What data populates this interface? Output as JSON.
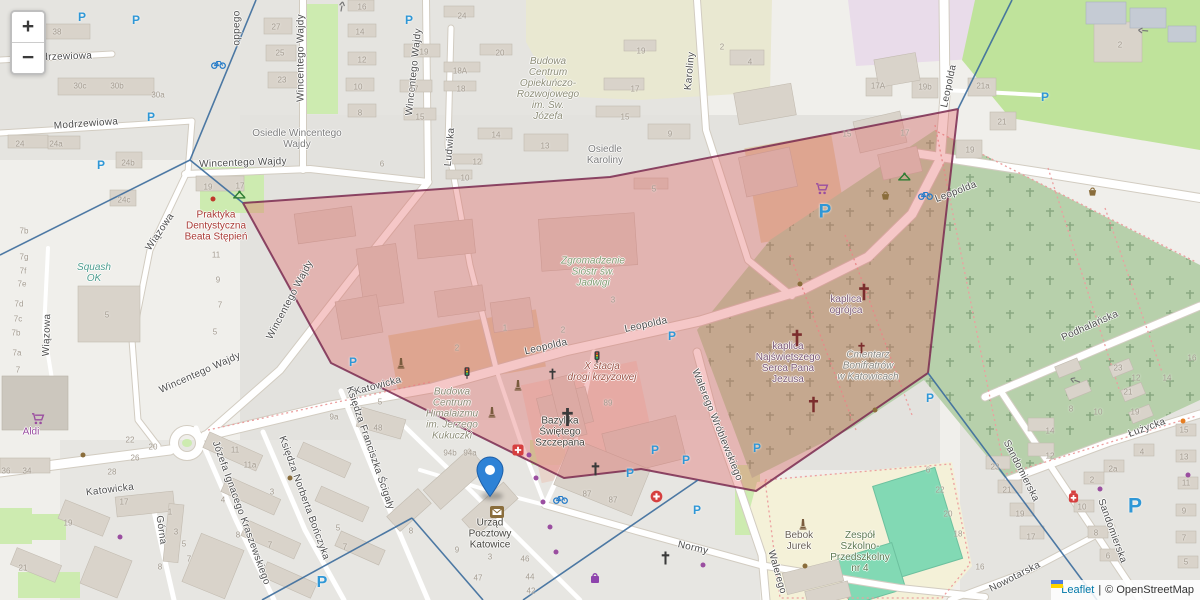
{
  "controls": {
    "zoom_in": "+",
    "zoom_out": "−"
  },
  "attribution": {
    "leaflet": "Leaflet",
    "separator": "|",
    "osm": "© OpenStreetMap"
  },
  "marker": {
    "title": "Urząd Pocztowy Katowice"
  },
  "colors": {
    "highlight_fill": "#e25b5b",
    "highlight_stroke": "#7a2a50",
    "boundary_line": "#3b6c9c",
    "marker_blue": "#2e82d6",
    "parking_blue": "#2f97d6",
    "link_blue": "#0078a8"
  },
  "overlay": {
    "highlight_polygon": [
      [
        243,
        203
      ],
      [
        610,
        177
      ],
      [
        958,
        109
      ],
      [
        928,
        373
      ],
      [
        756,
        491
      ],
      [
        641,
        469
      ],
      [
        564,
        478
      ],
      [
        331,
        363
      ]
    ],
    "boundary_lines": [
      [
        [
          256,
          0
        ],
        [
          190,
          160
        ]
      ],
      [
        [
          190,
          160
        ],
        [
          0,
          255
        ]
      ],
      [
        [
          190,
          160
        ],
        [
          243,
          203
        ]
      ],
      [
        [
          1012,
          0
        ],
        [
          958,
          109
        ]
      ],
      [
        [
          928,
          373
        ],
        [
          1097,
          600
        ]
      ],
      [
        [
          698,
          480
        ],
        [
          523,
          600
        ]
      ],
      [
        [
          412,
          518
        ],
        [
          483,
          600
        ]
      ],
      [
        [
          412,
          518
        ],
        [
          262,
          600
        ]
      ]
    ]
  },
  "street_labels": [
    {
      "t": "Modrzewiowa",
      "x": 60,
      "y": 57,
      "r": -2
    },
    {
      "t": "Modrzewiowa",
      "x": 86,
      "y": 124,
      "r": -4
    },
    {
      "t": "oppego",
      "x": 237,
      "y": 28,
      "r": -90
    },
    {
      "t": "Wincentego Wajdy",
      "x": 301,
      "y": 58,
      "r": -90
    },
    {
      "t": "Wincentego Wajdy",
      "x": 414,
      "y": 72,
      "r": -84
    },
    {
      "t": "Wincentego Wajdy",
      "x": 243,
      "y": 163,
      "r": -2
    },
    {
      "t": "Wincentego Wajdy",
      "x": 200,
      "y": 373,
      "r": -24
    },
    {
      "t": "Wincentego Wajdy",
      "x": 290,
      "y": 300,
      "r": -62
    },
    {
      "t": "Wiązowa",
      "x": 160,
      "y": 232,
      "r": -56
    },
    {
      "t": "Wiązowa",
      "x": 47,
      "y": 335,
      "r": -88
    },
    {
      "t": "Ludwika",
      "x": 450,
      "y": 147,
      "r": -85
    },
    {
      "t": "Karoliny",
      "x": 690,
      "y": 71,
      "r": -85
    },
    {
      "t": "Katowicka",
      "x": 378,
      "y": 386,
      "r": -15
    },
    {
      "t": "Katowicka",
      "x": 110,
      "y": 490,
      "r": -7
    },
    {
      "t": "Leopolda",
      "x": 546,
      "y": 347,
      "r": -13
    },
    {
      "t": "Leopolda",
      "x": 646,
      "y": 325,
      "r": -12
    },
    {
      "t": "Leopolda",
      "x": 956,
      "y": 192,
      "r": -21
    },
    {
      "t": "Leopolda",
      "x": 949,
      "y": 86,
      "r": -78
    },
    {
      "t": "Walerego Wróblewskiego",
      "x": 717,
      "y": 425,
      "r": 68
    },
    {
      "t": "Walerego",
      "x": 777,
      "y": 572,
      "r": 74
    },
    {
      "t": "Normy",
      "x": 693,
      "y": 548,
      "r": 13
    },
    {
      "t": "Nowotarska",
      "x": 1015,
      "y": 577,
      "r": -27
    },
    {
      "t": "Sandomierska",
      "x": 1021,
      "y": 471,
      "r": 63
    },
    {
      "t": "Sandomierska",
      "x": 1112,
      "y": 531,
      "r": 70
    },
    {
      "t": "Łużycka",
      "x": 1147,
      "y": 428,
      "r": -20
    },
    {
      "t": "Podhalańska",
      "x": 1090,
      "y": 326,
      "r": -24
    },
    {
      "t": "Górna",
      "x": 161,
      "y": 530,
      "r": 82
    },
    {
      "t": "Józefa Ignacego Kraszewskiego",
      "x": 241,
      "y": 513,
      "r": 70
    },
    {
      "t": "Księdza Norberta Bończyka",
      "x": 304,
      "y": 498,
      "r": 70
    },
    {
      "t": "Księdza Franciszka Ścigały",
      "x": 370,
      "y": 448,
      "r": 71
    }
  ],
  "place_labels": [
    {
      "lines": [
        "Osiedle Wincentego",
        "Wajdy"
      ],
      "x": 297,
      "y": 139,
      "c": "gray"
    },
    {
      "lines": [
        "Osiedle",
        "Karoliny"
      ],
      "x": 605,
      "y": 155,
      "c": "gray"
    },
    {
      "lines": [
        "Budowa",
        "Centrum",
        "Opiekuńczo-",
        "Rozwojowego",
        "im. Św.",
        "Józefa"
      ],
      "x": 548,
      "y": 89,
      "c": "constr"
    },
    {
      "lines": [
        "Budowa",
        "Centrum",
        "Himalaizmu",
        "im. Jerzego",
        "Kukuczki"
      ],
      "x": 452,
      "y": 414,
      "c": "constr"
    },
    {
      "lines": [
        "Praktyka",
        "Dentystyczna",
        "Beata Stępień"
      ],
      "x": 216,
      "y": 226,
      "c": "red"
    },
    {
      "lines": [
        "Squash",
        "OK"
      ],
      "x": 94,
      "y": 273,
      "c": "teal"
    },
    {
      "lines": [
        "Zgromadzenie",
        "Sióstr św.",
        "Jadwigi"
      ],
      "x": 593,
      "y": 272,
      "c": "green"
    },
    {
      "lines": [
        "X stacja",
        "drogi krzyżowej"
      ],
      "x": 602,
      "y": 372,
      "c": "hist"
    },
    {
      "lines": [
        "Bazylika",
        "Świętego",
        "Szczepana"
      ],
      "x": 560,
      "y": 432,
      "c": "dark"
    },
    {
      "lines": [
        "kaplica",
        "ogrójca"
      ],
      "x": 846,
      "y": 305,
      "c": "relig"
    },
    {
      "lines": [
        "kaplica",
        "Najświętszego",
        "Serca Pana",
        "Jezusa"
      ],
      "x": 788,
      "y": 363,
      "c": "relig"
    },
    {
      "lines": [
        "Cmentarz",
        "Bonifratrów",
        "w Katowicach"
      ],
      "x": 868,
      "y": 366,
      "c": "cem"
    },
    {
      "lines": [
        "Zespół",
        "Szkolno-",
        "Przedszkolny",
        "nr 4"
      ],
      "x": 860,
      "y": 552,
      "c": "school"
    },
    {
      "lines": [
        "Bebok",
        "Jurek"
      ],
      "x": 799,
      "y": 541,
      "c": "poi"
    },
    {
      "lines": [
        "Urząd",
        "Pocztowy",
        "Katowice"
      ],
      "x": 490,
      "y": 534,
      "c": "dark"
    },
    {
      "lines": [
        "Aldi"
      ],
      "x": 31,
      "y": 432,
      "c": "shop"
    }
  ],
  "house_numbers": [
    [
      "38",
      57,
      32
    ],
    [
      "30c",
      80,
      86
    ],
    [
      "30b",
      117,
      86
    ],
    [
      "30a",
      158,
      95
    ],
    [
      "24",
      20,
      144
    ],
    [
      "24a",
      56,
      144
    ],
    [
      "24b",
      128,
      163
    ],
    [
      "24c",
      124,
      200
    ],
    [
      "27",
      276,
      27
    ],
    [
      "25",
      280,
      53
    ],
    [
      "23",
      282,
      80
    ],
    [
      "16",
      362,
      7
    ],
    [
      "14",
      360,
      32
    ],
    [
      "12",
      362,
      60
    ],
    [
      "10",
      358,
      87
    ],
    [
      "8",
      360,
      113
    ],
    [
      "19",
      424,
      52
    ],
    [
      "17",
      414,
      89
    ],
    [
      "15",
      420,
      117
    ],
    [
      "6",
      382,
      164
    ],
    [
      "24",
      462,
      16
    ],
    [
      "20",
      500,
      53
    ],
    [
      "18A",
      460,
      71
    ],
    [
      "18",
      461,
      89
    ],
    [
      "14",
      496,
      135
    ],
    [
      "13",
      545,
      146
    ],
    [
      "12",
      477,
      162
    ],
    [
      "10",
      465,
      178
    ],
    [
      "19",
      641,
      51
    ],
    [
      "17",
      635,
      89
    ],
    [
      "15",
      625,
      117
    ],
    [
      "9",
      670,
      134
    ],
    [
      "5",
      654,
      189
    ],
    [
      "2",
      722,
      47
    ],
    [
      "4",
      750,
      62
    ],
    [
      "2",
      1120,
      45
    ],
    [
      "17A",
      878,
      86
    ],
    [
      "19b",
      925,
      87
    ],
    [
      "21a",
      983,
      86
    ],
    [
      "21",
      1002,
      122
    ],
    [
      "19",
      970,
      150
    ],
    [
      "17",
      905,
      133
    ],
    [
      "15",
      847,
      134
    ],
    [
      "1",
      505,
      328
    ],
    [
      "2",
      563,
      330
    ],
    [
      "3",
      613,
      300
    ],
    [
      "2",
      457,
      348
    ],
    [
      "5",
      380,
      402
    ],
    [
      "48",
      378,
      428
    ],
    [
      "9a",
      334,
      417
    ],
    [
      "89",
      608,
      403
    ],
    [
      "94b",
      450,
      453
    ],
    [
      "94a",
      470,
      453
    ],
    [
      "87",
      587,
      494
    ],
    [
      "87",
      613,
      500
    ],
    [
      "8",
      411,
      531
    ],
    [
      "9",
      457,
      550
    ],
    [
      "3",
      490,
      557
    ],
    [
      "46",
      525,
      559
    ],
    [
      "44",
      530,
      577
    ],
    [
      "47",
      478,
      578
    ],
    [
      "42",
      531,
      591
    ],
    [
      "22",
      130,
      440
    ],
    [
      "20",
      153,
      447
    ],
    [
      "26",
      135,
      458
    ],
    [
      "28",
      112,
      472
    ],
    [
      "17",
      124,
      502
    ],
    [
      "36",
      6,
      471
    ],
    [
      "34",
      27,
      471
    ],
    [
      "19",
      68,
      523
    ],
    [
      "21",
      23,
      568
    ],
    [
      "1",
      170,
      512
    ],
    [
      "3",
      176,
      532
    ],
    [
      "5",
      184,
      544
    ],
    [
      "7",
      189,
      559
    ],
    [
      "8",
      160,
      567
    ],
    [
      "11",
      235,
      450
    ],
    [
      "11a",
      250,
      465
    ],
    [
      "3",
      272,
      492
    ],
    [
      "4",
      223,
      500
    ],
    [
      "8",
      238,
      535
    ],
    [
      "7",
      270,
      545
    ],
    [
      "5",
      338,
      528
    ],
    [
      "7",
      345,
      547
    ],
    [
      "7b",
      24,
      231
    ],
    [
      "7g",
      24,
      257
    ],
    [
      "7f",
      23,
      271
    ],
    [
      "7e",
      22,
      284
    ],
    [
      "7d",
      19,
      304
    ],
    [
      "7c",
      18,
      319
    ],
    [
      "7b",
      16,
      333
    ],
    [
      "7a",
      17,
      353
    ],
    [
      "7",
      18,
      370
    ],
    [
      "5",
      107,
      315
    ],
    [
      "19",
      208,
      187
    ],
    [
      "17",
      240,
      186
    ],
    [
      "11",
      216,
      255
    ],
    [
      "9",
      218,
      280
    ],
    [
      "7",
      220,
      305
    ],
    [
      "5",
      215,
      332
    ],
    [
      "6",
      928,
      470
    ],
    [
      "22",
      940,
      490
    ],
    [
      "20",
      948,
      514
    ],
    [
      "18",
      958,
      534
    ],
    [
      "16",
      980,
      567
    ],
    [
      "23",
      1118,
      368
    ],
    [
      "21",
      1128,
      392
    ],
    [
      "19",
      1135,
      412
    ],
    [
      "12",
      1136,
      378
    ],
    [
      "14",
      1167,
      378
    ],
    [
      "16",
      1192,
      358
    ],
    [
      "8",
      1071,
      409
    ],
    [
      "10",
      1098,
      412
    ],
    [
      "14",
      1050,
      431
    ],
    [
      "12",
      1050,
      456
    ],
    [
      "23",
      995,
      467
    ],
    [
      "21",
      1007,
      490
    ],
    [
      "19",
      1020,
      514
    ],
    [
      "17",
      1031,
      537
    ],
    [
      "4",
      1142,
      452
    ],
    [
      "2a",
      1113,
      469
    ],
    [
      "2",
      1092,
      480
    ],
    [
      "10",
      1082,
      507
    ],
    [
      "8",
      1096,
      533
    ],
    [
      "6",
      1108,
      556
    ],
    [
      "15",
      1184,
      430
    ],
    [
      "13",
      1184,
      457
    ],
    [
      "11",
      1186,
      483
    ],
    [
      "9",
      1184,
      511
    ],
    [
      "7",
      1184,
      538
    ],
    [
      "5",
      1186,
      562
    ]
  ],
  "icons": [
    {
      "k": "parking",
      "x": 82,
      "y": 17
    },
    {
      "k": "parking",
      "x": 136,
      "y": 20
    },
    {
      "k": "parking",
      "x": 409,
      "y": 20
    },
    {
      "k": "parking",
      "x": 101,
      "y": 165
    },
    {
      "k": "parking",
      "x": 151,
      "y": 117
    },
    {
      "k": "parking",
      "x": 353,
      "y": 362
    },
    {
      "k": "parking",
      "x": 672,
      "y": 336
    },
    {
      "k": "parking",
      "x": 655,
      "y": 450
    },
    {
      "k": "parking",
      "x": 686,
      "y": 460
    },
    {
      "k": "parking",
      "x": 757,
      "y": 448
    },
    {
      "k": "parking",
      "x": 697,
      "y": 510
    },
    {
      "k": "parking",
      "x": 630,
      "y": 473
    },
    {
      "k": "parking",
      "x": 930,
      "y": 398
    },
    {
      "k": "parking",
      "x": 1045,
      "y": 97
    },
    {
      "k": "parking",
      "x": 825,
      "y": 212,
      "s": 19
    },
    {
      "k": "parking",
      "x": 1135,
      "y": 506,
      "s": 21
    },
    {
      "k": "parking",
      "x": 322,
      "y": 583,
      "s": 16
    },
    {
      "k": "cart",
      "x": 31,
      "y": 413
    },
    {
      "k": "cart",
      "x": 815,
      "y": 183
    },
    {
      "k": "bag",
      "x": 590,
      "y": 572
    },
    {
      "k": "bike",
      "x": 918,
      "y": 190
    },
    {
      "k": "bike",
      "x": 553,
      "y": 494
    },
    {
      "k": "bike",
      "x": 13,
      "y": 60
    },
    {
      "k": "bike",
      "x": 211,
      "y": 59
    },
    {
      "k": "basket",
      "x": 1087,
      "y": 186
    },
    {
      "k": "basket",
      "x": 880,
      "y": 190
    },
    {
      "k": "dot_brown",
      "x": 800,
      "y": 284
    },
    {
      "k": "dot_brown",
      "x": 875,
      "y": 410
    },
    {
      "k": "dot_brown",
      "x": 805,
      "y": 566
    },
    {
      "k": "dot_brown",
      "x": 83,
      "y": 455
    },
    {
      "k": "dot_brown",
      "x": 290,
      "y": 478
    },
    {
      "k": "medcircle",
      "x": 650,
      "y": 490
    },
    {
      "k": "pharmacy",
      "x": 1068,
      "y": 490
    },
    {
      "k": "redbox",
      "x": 512,
      "y": 444
    },
    {
      "k": "monument",
      "x": 397,
      "y": 357
    },
    {
      "k": "monument",
      "x": 514,
      "y": 379
    },
    {
      "k": "monument",
      "x": 488,
      "y": 406
    },
    {
      "k": "monument",
      "x": 799,
      "y": 518
    },
    {
      "k": "cross_dark",
      "x": 560,
      "y": 407,
      "s": 15
    },
    {
      "k": "cross_dark",
      "x": 590,
      "y": 462,
      "s": 11
    },
    {
      "k": "cross_dark",
      "x": 660,
      "y": 551,
      "s": 11
    },
    {
      "k": "cross_dark",
      "x": 548,
      "y": 368,
      "s": 9
    },
    {
      "k": "cross_red",
      "x": 857,
      "y": 283,
      "s": 14
    },
    {
      "k": "cross_red",
      "x": 790,
      "y": 329,
      "s": 14
    },
    {
      "k": "cross_red",
      "x": 807,
      "y": 396,
      "s": 13
    },
    {
      "k": "cross_red",
      "x": 857,
      "y": 342,
      "s": 9
    },
    {
      "k": "traffic",
      "x": 594,
      "y": 351
    },
    {
      "k": "traffic",
      "x": 464,
      "y": 367
    },
    {
      "k": "playground",
      "x": 232,
      "y": 190
    },
    {
      "k": "playground",
      "x": 897,
      "y": 172
    },
    {
      "k": "dot_red",
      "x": 213,
      "y": 199
    },
    {
      "k": "dot_purple",
      "x": 120,
      "y": 537
    },
    {
      "k": "dot_purple",
      "x": 529,
      "y": 455
    },
    {
      "k": "dot_purple",
      "x": 536,
      "y": 478
    },
    {
      "k": "dot_purple",
      "x": 543,
      "y": 502
    },
    {
      "k": "dot_purple",
      "x": 550,
      "y": 527
    },
    {
      "k": "dot_purple",
      "x": 556,
      "y": 552
    },
    {
      "k": "dot_purple",
      "x": 1100,
      "y": 489
    },
    {
      "k": "dot_purple",
      "x": 703,
      "y": 565
    },
    {
      "k": "dot_purple",
      "x": 1188,
      "y": 475
    },
    {
      "k": "dot_orange",
      "x": 1183,
      "y": 421
    },
    {
      "k": "post",
      "x": 490,
      "y": 506
    },
    {
      "k": "arrow",
      "x": 338,
      "y": 11,
      "r": -80
    },
    {
      "k": "arrow",
      "x": 1148,
      "y": 34,
      "r": 185
    },
    {
      "k": "arrow",
      "x": 1079,
      "y": 385,
      "r": 200
    }
  ]
}
